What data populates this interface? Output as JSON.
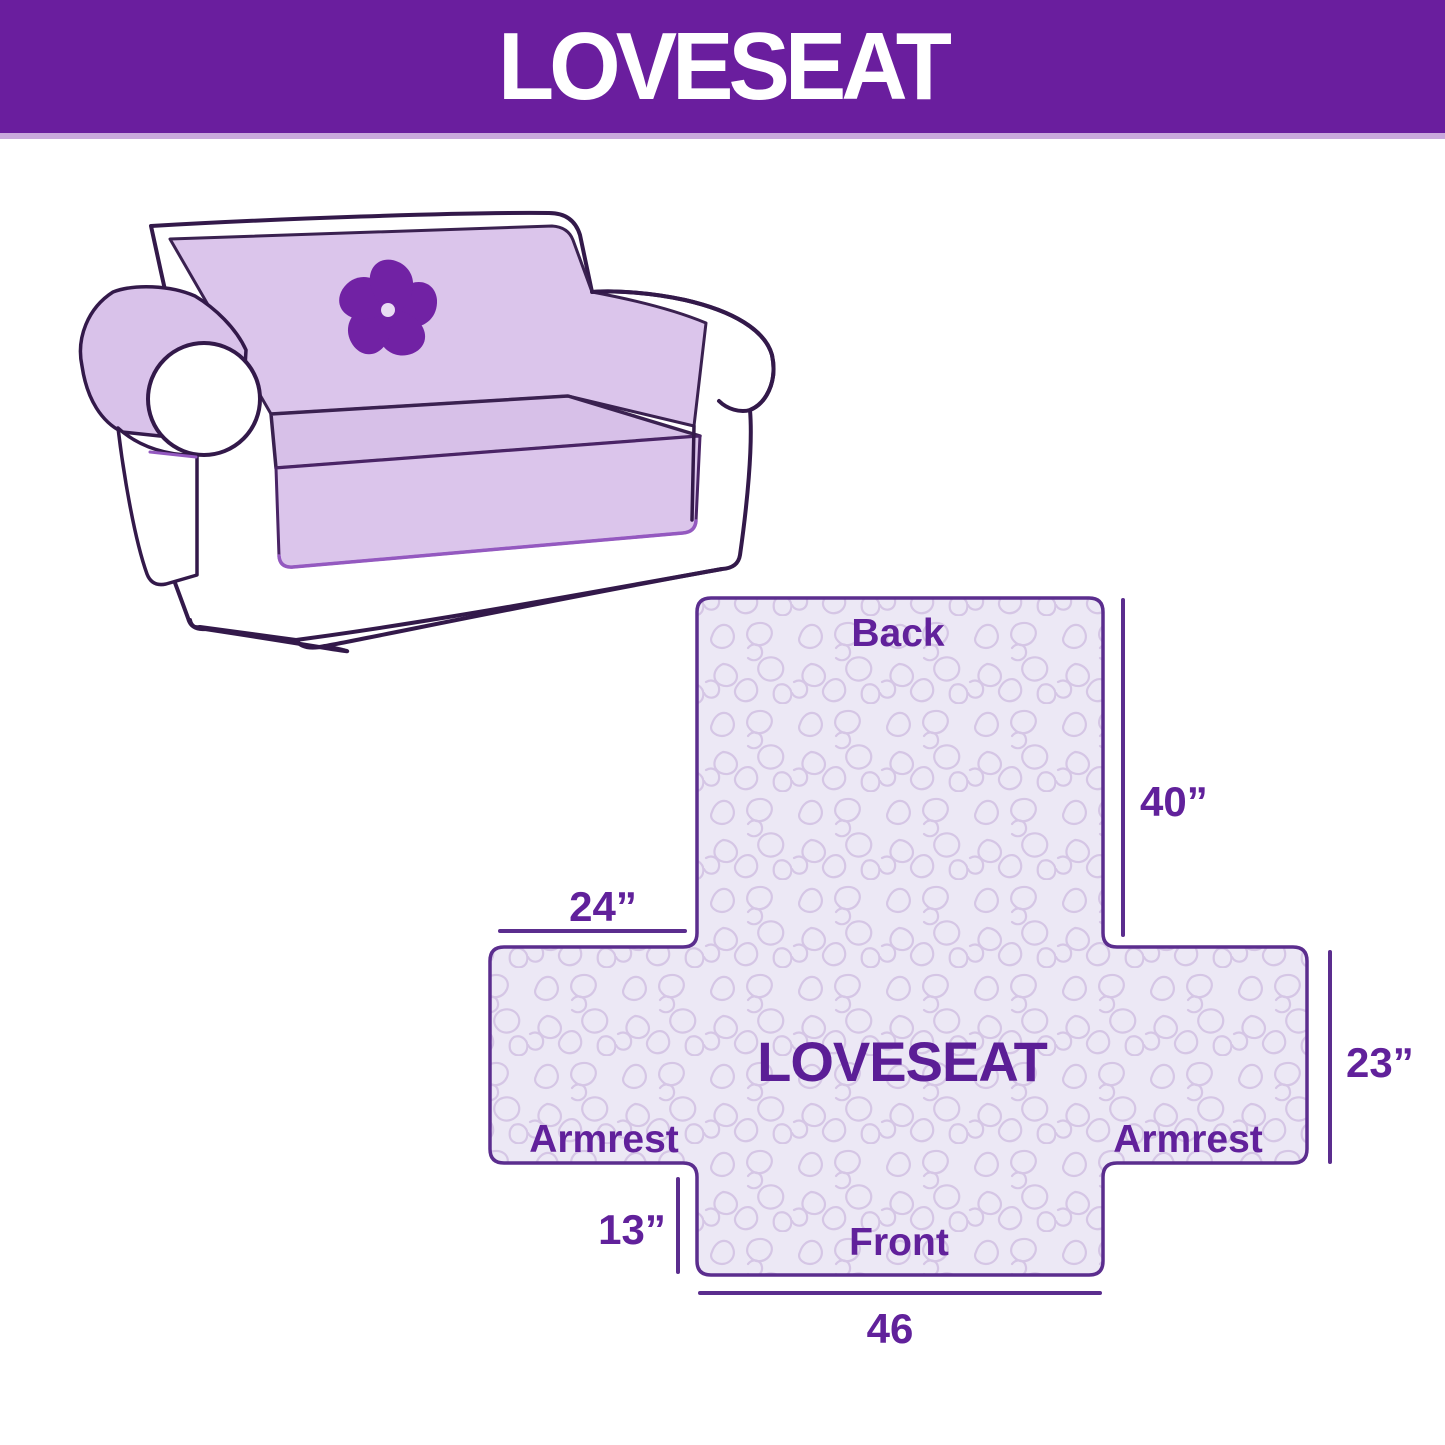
{
  "header": {
    "title": "LOVESEAT"
  },
  "illustration": {
    "description": "loveseat sofa draped with quilted lavender furniture cover",
    "logo": "pinwheel"
  },
  "diagram": {
    "center_label": "LOVESEAT",
    "back_label": "Back",
    "front_label": "Front",
    "armrest_left_label": "Armrest",
    "armrest_right_label": "Armrest",
    "measurements": {
      "back_height": "40”",
      "armrest_top_width": "24”",
      "armrest_side_height": "23”",
      "front_flap_height": "13”",
      "front_bottom_width": "46"
    },
    "colors": {
      "banner": "#6A1E9E",
      "banner_strip": "#C9A9DC",
      "label_text": "#61219B",
      "dimension_lines": "#5B2D8E",
      "diagram_fill": "#ECE8F5",
      "diagram_pattern_lines": "#D5C6E5",
      "diagram_border": "#5B2D8E",
      "sofa_outline": "#33194A",
      "cover_lavender": "#DBC5EB",
      "logo_purple": "#7122A4"
    }
  }
}
